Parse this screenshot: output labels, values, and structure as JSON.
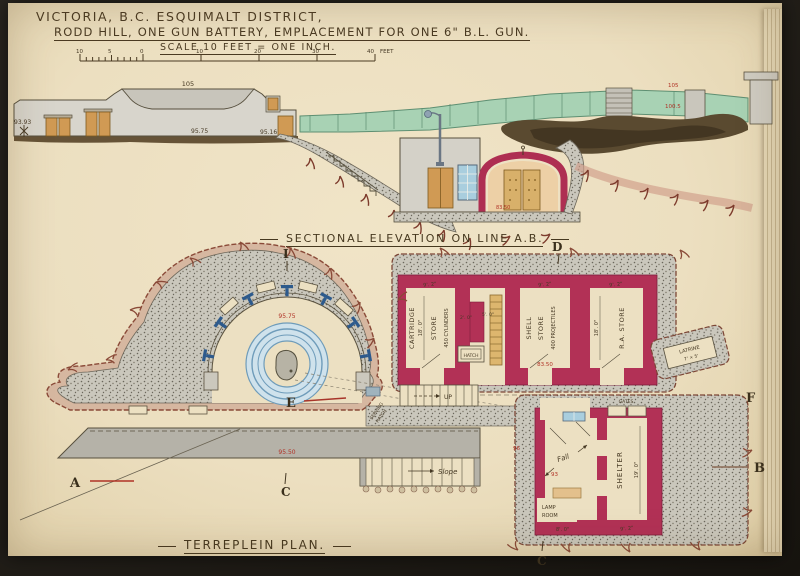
{
  "title": {
    "line1": "VICTORIA, B.C. ESQUIMALT DISTRICT,",
    "line2": "RODD HILL, ONE GUN BATTERY, EMPLACEMENT FOR ONE 6\" B.L. GUN.",
    "scale_label": "SCALE 10 FEET = ONE INCH."
  },
  "scale_bar": {
    "t0": "10",
    "t1": "5",
    "t2": "0",
    "t3": "10",
    "t4": "20",
    "t5": "30",
    "t6": "40",
    "unit": "FEET"
  },
  "elevation": {
    "caption": "SECTIONAL ELEVATION ON LINE A.B.",
    "crest": "105",
    "terreplein": "95.75",
    "slope": "95.16",
    "bench": "93.93",
    "magazine_floor": "83.50",
    "red_upper": "105",
    "red_lower": "100.5"
  },
  "plan": {
    "caption": "TERREPLEIN PLAN.",
    "emplacement_level": "95.75",
    "terreplein_level": "95.50",
    "court_level": "96",
    "fall_level": "93",
    "cartridge": {
      "n1": "CARTRIDGE",
      "n2": "STORE",
      "n3": "450 CYLINDERS",
      "l": "18'. 0\"",
      "w": "9'. 2\""
    },
    "shell": {
      "n1": "SHELL",
      "n2": "STORE",
      "n3": "400 PROJECTILES",
      "w": "9'. 2\"",
      "floor": "83.50"
    },
    "ra": {
      "n1": "R.A. STORE",
      "l": "18'. 0\"",
      "w": "9'. 2\""
    },
    "shelter": {
      "n1": "SHELTER",
      "l": "19'. 0\"",
      "w": "9'. 2\""
    },
    "lamp": {
      "n1": "LAMP",
      "n2": "ROOM",
      "w": "8'. 0\""
    },
    "latrine": {
      "n1": "LATRINE",
      "n2": "7' × 5'"
    },
    "lobby": {
      "d1": "2'. 0\"",
      "d2": "5'. 0\""
    },
    "hatch": "HATCH",
    "up": "UP",
    "gates": "GATES",
    "fall": "Fall",
    "slope_word": "Slope",
    "serving1": "SERVING",
    "serving2": "HATCH"
  },
  "letters": {
    "a": "A",
    "b": "B",
    "c": "C",
    "c2": "C",
    "d": "D",
    "e": "E",
    "f": "F",
    "i": "I"
  }
}
